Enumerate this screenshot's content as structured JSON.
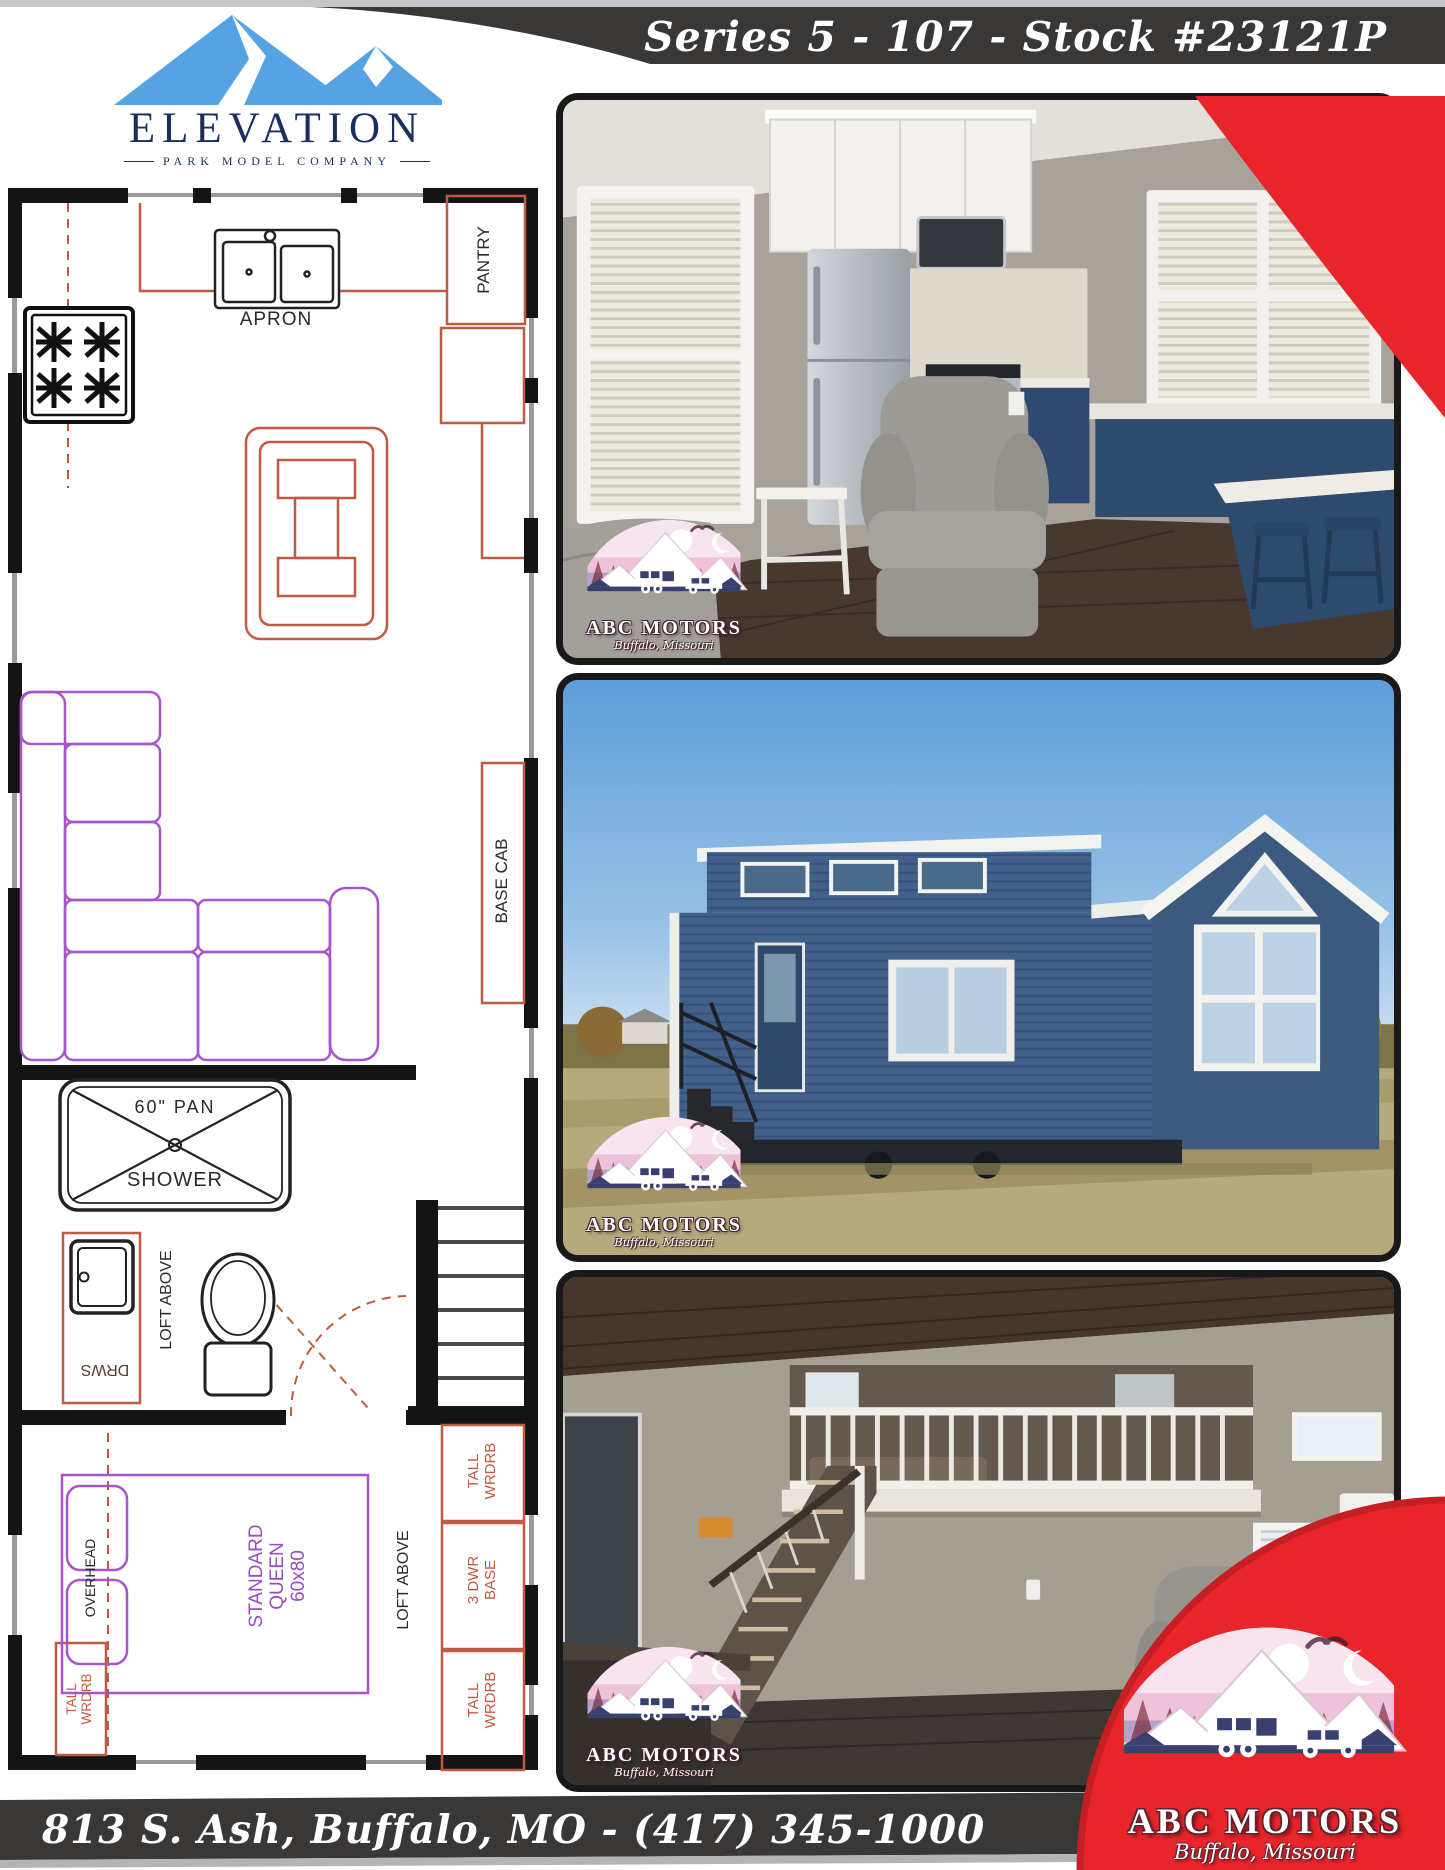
{
  "header": {
    "banner": "Series 5 - 107 - Stock #23121P"
  },
  "brand": {
    "name": "ELEVATION",
    "tagline": "PARK MODEL COMPANY"
  },
  "floorplan": {
    "apron": "APRON",
    "pantry": "PANTRY",
    "base_cab": "BASE CAB",
    "shower_pan": "60\" PAN",
    "shower": "SHOWER",
    "loft_above_bath": "LOFT ABOVE",
    "drawers": "DRWS",
    "overhead": "OVERHEAD",
    "bed": {
      "l1": "STANDARD",
      "l2": "QUEEN",
      "l3": "60x80"
    },
    "wardrobe_right_top": {
      "l1": "TALL",
      "l2": "WRDRB"
    },
    "dresser": {
      "l1": "3 DWR",
      "l2": "BASE"
    },
    "loft_above_bedroom": "LOFT ABOVE",
    "wardrobe_left": {
      "l1": "TALL",
      "l2": "WRDRB"
    }
  },
  "dealer": {
    "name": "ABC MOTORS",
    "location": "Buffalo, Missouri",
    "address": "813 S. Ash, Buffalo, MO - (417) 345-1000"
  },
  "colors": {
    "accent_red": "#e8252b",
    "band_dark": "#3a3737",
    "logo_blue": "#55a3e3",
    "logo_navy": "#1c2e5e",
    "plan_red": "#c05b43",
    "plan_purple": "#a050c8"
  }
}
